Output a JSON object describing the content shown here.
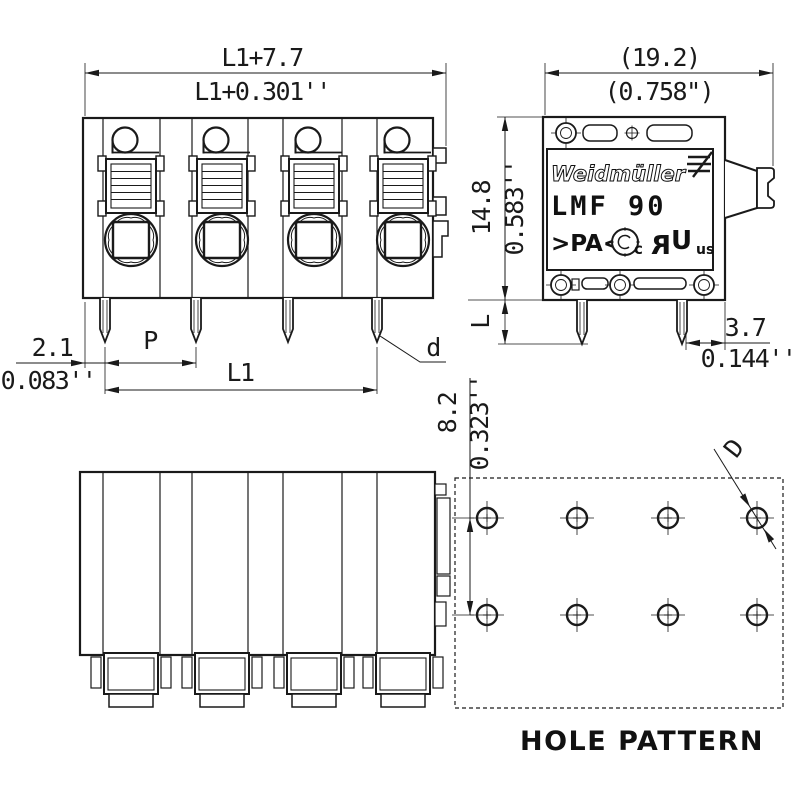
{
  "colors": {
    "line": "#1a1a1a",
    "background": "#ffffff"
  },
  "dimensions": {
    "width_top": {
      "metric": "L1+7.7",
      "imperial": "L1+0.301''"
    },
    "depth_top": {
      "metric": "(19.2)",
      "imperial": "(0.758\")"
    },
    "height_side": {
      "metric": "14.8",
      "imperial": "0.583''"
    },
    "pin_length_label": "L",
    "pin_offset": {
      "metric": "2.1",
      "imperial": "0.083''"
    },
    "pitch_label": "P",
    "span_label": "L1",
    "pin_diameter_label": "d",
    "rear_offset": {
      "metric": "3.7",
      "imperial": "0.144''"
    },
    "hole_row_spacing": {
      "metric": "8.2",
      "imperial": "0.323''"
    },
    "hole_diameter_label": "D"
  },
  "product_label": {
    "brand": "Weidmüller",
    "model": "LMF 90",
    "material": ">PA<",
    "ul_prefix": "c",
    "ul_letter_r": "R",
    "ul_letter_u": "U",
    "ul_suffix": "us"
  },
  "hole_pattern": {
    "title": "HOLE PATTERN"
  }
}
